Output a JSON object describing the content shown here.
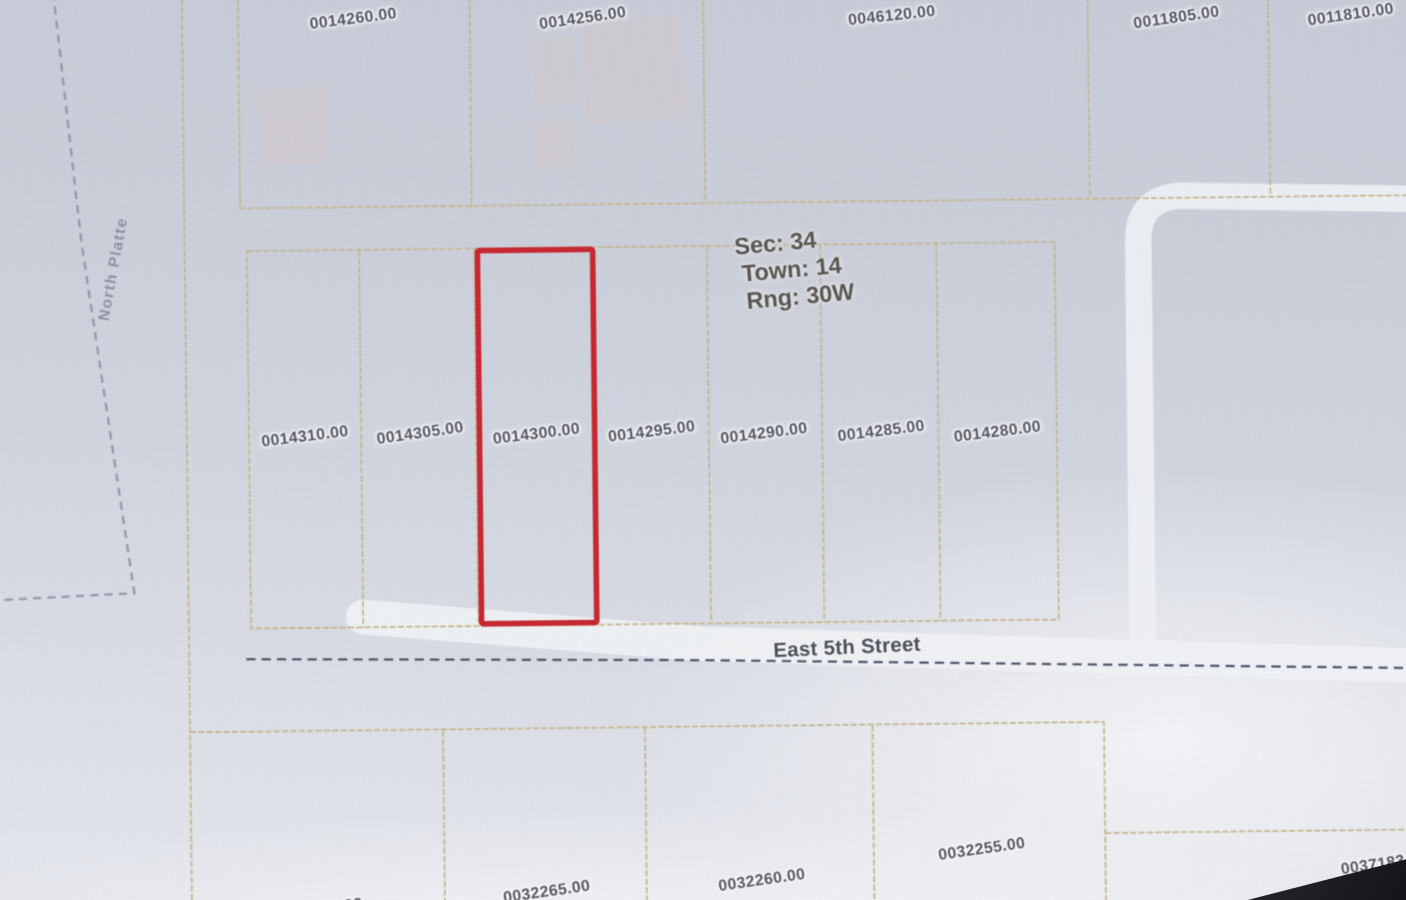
{
  "parcel_labels": {
    "top_row": [
      "0014260.00",
      "0014256.00",
      "0046120.00",
      "0011805.00",
      "0011810.00"
    ],
    "middle_row": [
      "0014310.00",
      "0014305.00",
      "0014300.00",
      "0014295.00",
      "0014290.00",
      "0014285.00",
      "0014280.00"
    ],
    "bottom_row": [
      "0032270.00",
      "0032265.00",
      "0032260.00",
      "0032255.00",
      "0037183.0"
    ]
  },
  "selected_parcel": {
    "id": "0014300.00",
    "outline_color": "#c8232c"
  },
  "plss_annotation": {
    "section": "Sec: 34",
    "township": "Town: 14",
    "range": "Rng: 30W"
  },
  "street": {
    "name": "East 5th Street"
  },
  "river": {
    "name": "North Platte"
  },
  "colors": {
    "parcel_boundary": "#c6b68a",
    "road_fill": "#f1f3f6",
    "street_centerline": "#4b5068",
    "river_boundary": "#8e92ad",
    "parcel_label_text": "#4e515c",
    "selected_outline": "#c8232c"
  }
}
